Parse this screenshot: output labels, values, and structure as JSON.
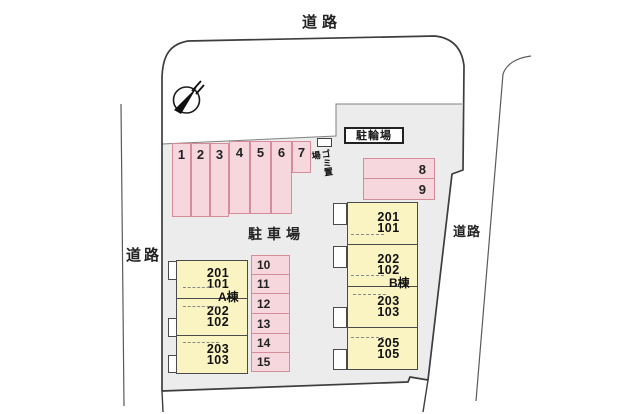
{
  "plan": {
    "roads": {
      "top": "道路",
      "left": "道路",
      "right": "道路"
    },
    "areas": {
      "parking_lot": "駐車場",
      "bicycle_parking": "駐輪場",
      "garbage": "ゴミ置場"
    },
    "parking": {
      "top_row": [
        "1",
        "2",
        "3",
        "4",
        "5",
        "6",
        "7"
      ],
      "east_row": [
        "8",
        "9"
      ],
      "center_column": [
        "10",
        "11",
        "12",
        "13",
        "14",
        "15"
      ]
    },
    "buildings": {
      "a": {
        "name": "A棟",
        "units": [
          {
            "upper": "201",
            "lower": "101"
          },
          {
            "upper": "202",
            "lower": "102"
          },
          {
            "upper": "203",
            "lower": "103"
          }
        ]
      },
      "b": {
        "name": "B棟",
        "units": [
          {
            "upper": "201",
            "lower": "101"
          },
          {
            "upper": "202",
            "lower": "102"
          },
          {
            "upper": "203",
            "lower": "103"
          },
          {
            "upper": "205",
            "lower": "105"
          }
        ]
      }
    },
    "icons": {
      "compass": "north-compass"
    },
    "colors": {
      "stall_fill": "#f7d7de",
      "stall_border": "#d58d9b",
      "building_fill": "#faf3c2",
      "building_border": "#4a4a4a",
      "site_area_fill": "#ececec",
      "site_outline": "#3d3d3d"
    }
  }
}
